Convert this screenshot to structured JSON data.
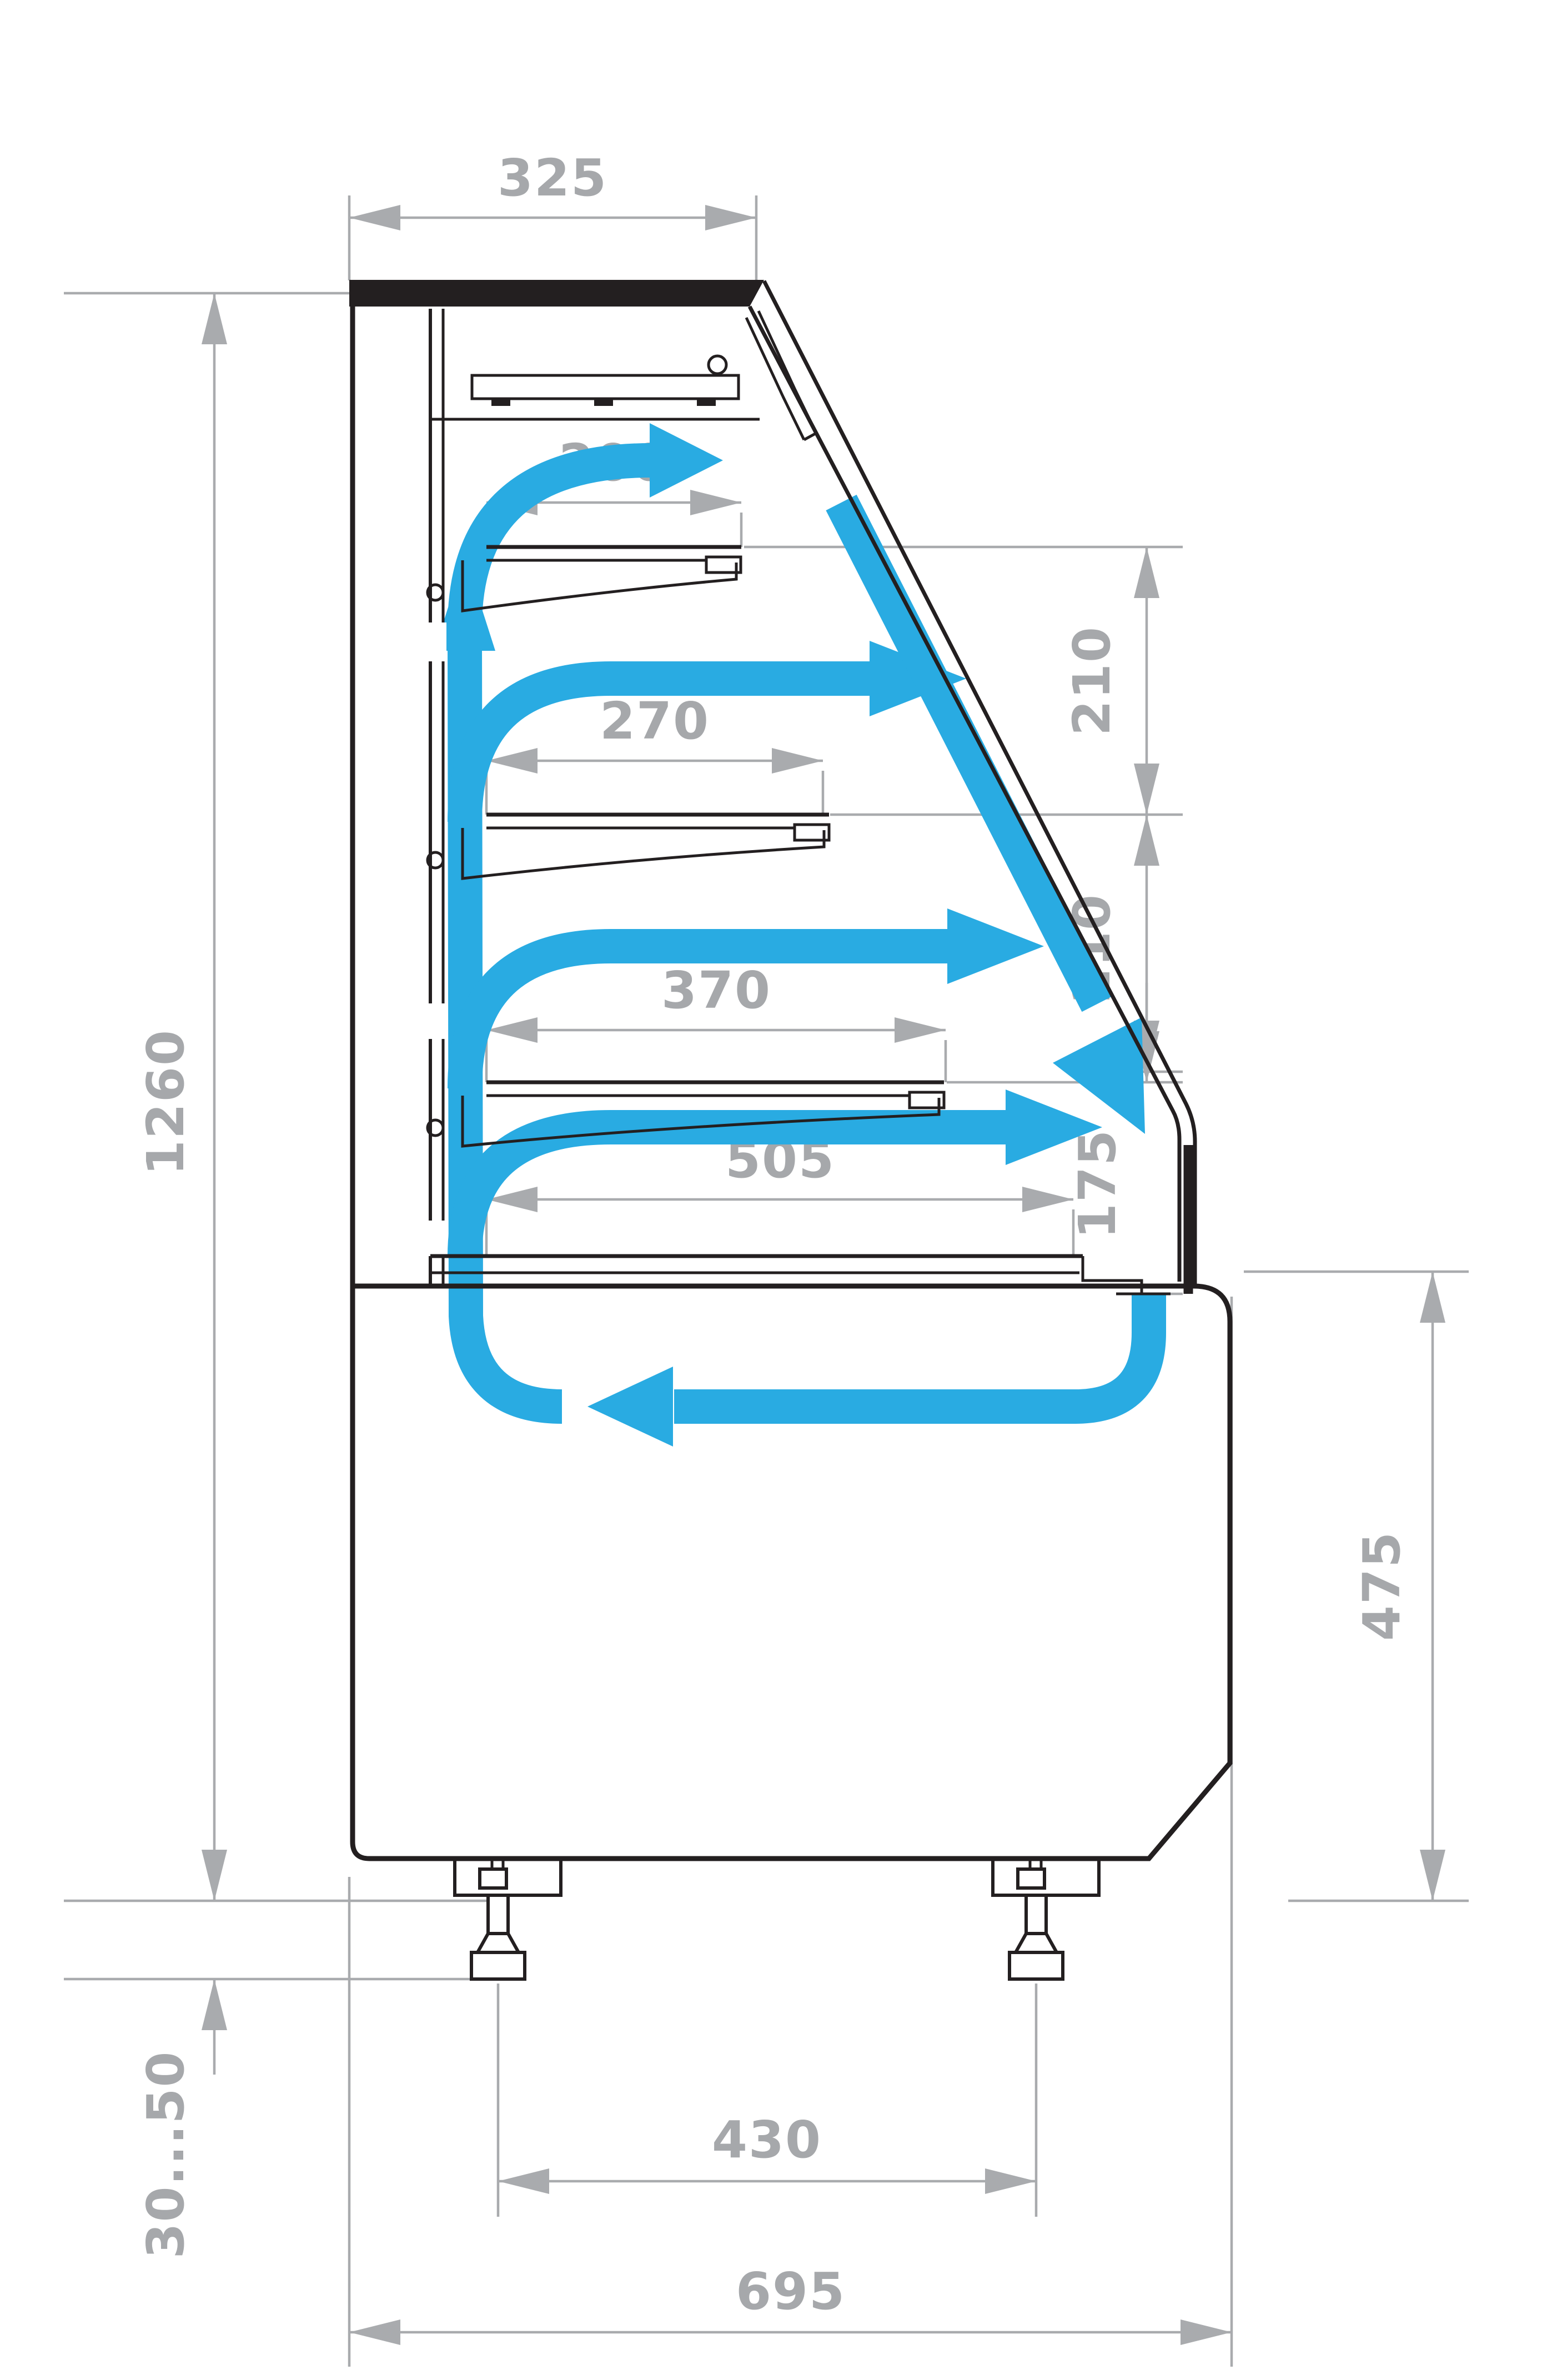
{
  "diagram": {
    "type": "technical-drawing",
    "subject": "refrigerated-display-case-side-section-with-airflow",
    "units_implied": "mm",
    "dimensions": {
      "top_depth": "325",
      "overall_height": "1260",
      "shelf1_depth": "200",
      "shelf2_depth": "270",
      "shelf3_depth": "370",
      "deck_depth": "505",
      "tier_gap_upper": "210",
      "tier_gap_lower": "210",
      "front_opening_height": "175",
      "base_height": "475",
      "leg_adjust_range": "30...50",
      "leg_spacing": "430",
      "overall_depth": "695"
    },
    "colors": {
      "airflow_arrows": "#29abe2",
      "dimension_lines": "#a9abae",
      "cabinet_outline": "#231f20",
      "background": "#ffffff"
    },
    "airflow": {
      "description": "cold air loop: rises in rear duct, blows over each shelf tier, falls as air curtain along glass, returns under deck",
      "arrow_count": 7
    }
  }
}
